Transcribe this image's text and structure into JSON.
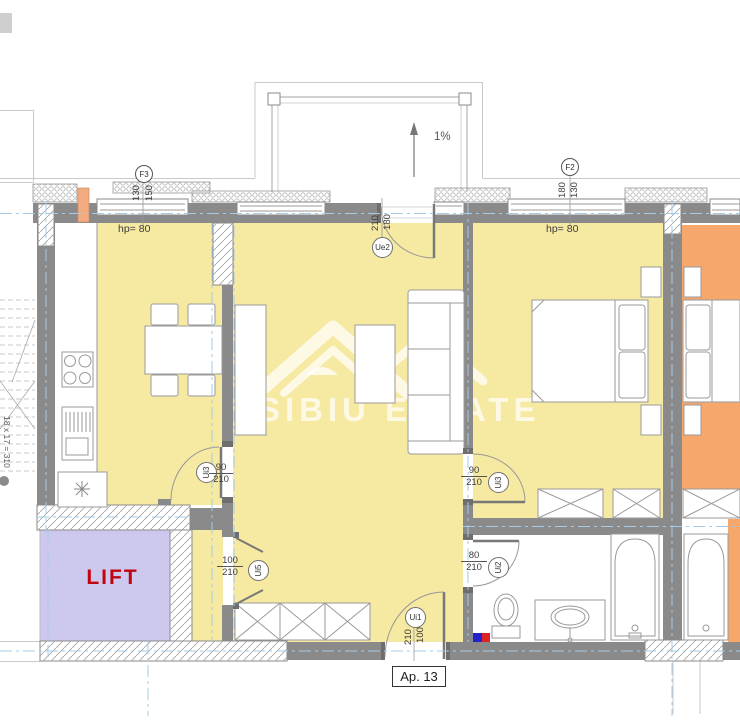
{
  "labels": {
    "apartment": "Ap. 13",
    "lift": "LIFT",
    "slope": "1%",
    "stairs": "18 x 17 = 310",
    "hp_left": "hp= 80",
    "hp_right": "hp= 80",
    "watermark": "SIBIU ESTATE"
  },
  "grid_markers": {
    "f3": {
      "id": "F3",
      "dim_left": "130",
      "dim_right": "150"
    },
    "f2": {
      "id": "F2",
      "dim_left": "180",
      "dim_right": "130"
    }
  },
  "doors": {
    "ue2": {
      "id": "Ue2",
      "width": "180",
      "height": "210"
    },
    "ui3_kitchen": {
      "id": "Ui3",
      "width": "90",
      "height": "210"
    },
    "ui5": {
      "id": "Ui5",
      "width": "100",
      "height": "210"
    },
    "ui3_bedroom": {
      "id": "Ui3",
      "width": "90",
      "height": "210"
    },
    "ui2": {
      "id": "Ui2",
      "width": "80",
      "height": "210"
    },
    "ui1": {
      "id": "Ui1",
      "width": "100",
      "height": "210"
    }
  },
  "colors": {
    "room_fill": "#F6E9A2",
    "neighbor_fill": "#F5A76C",
    "lift_fill": "#CDC9EE",
    "wall": "#8A8A8A",
    "axis": "#A6CBE7",
    "lift_text": "#C00511",
    "accent_column": "#F3AC80",
    "marker_blue": "#2323CE",
    "marker_red": "#DE2121",
    "watermark_color": "rgba(255,255,255,0.72)"
  }
}
